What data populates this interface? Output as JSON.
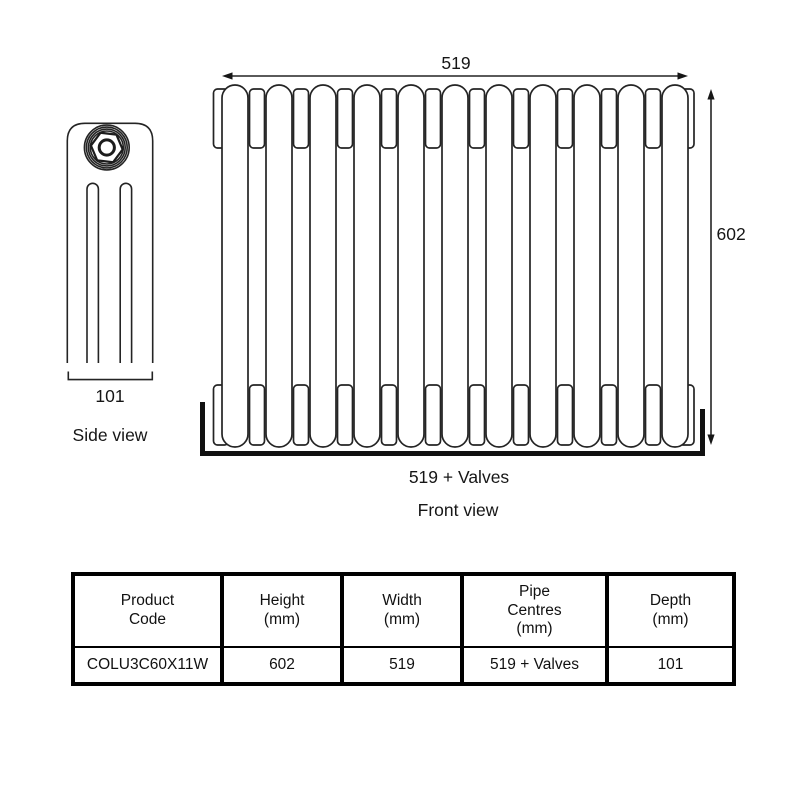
{
  "side_view": {
    "label": "Side view",
    "depth_dim": "101"
  },
  "front_view": {
    "label": "Front view",
    "width_dim": "519",
    "height_dim": "602",
    "pipe_centres_dim": "519 + Valves",
    "sections": 11
  },
  "table": {
    "headers": [
      "Product\nCode",
      "Height\n(mm)",
      "Width\n(mm)",
      "Pipe\nCentres\n(mm)",
      "Depth\n(mm)"
    ],
    "rows": [
      [
        "COLU3C60X11W",
        "602",
        "519",
        "519 + Valves",
        "101"
      ]
    ]
  },
  "colors": {
    "line": "#242424",
    "text": "#161616",
    "table_border": "#000000"
  }
}
